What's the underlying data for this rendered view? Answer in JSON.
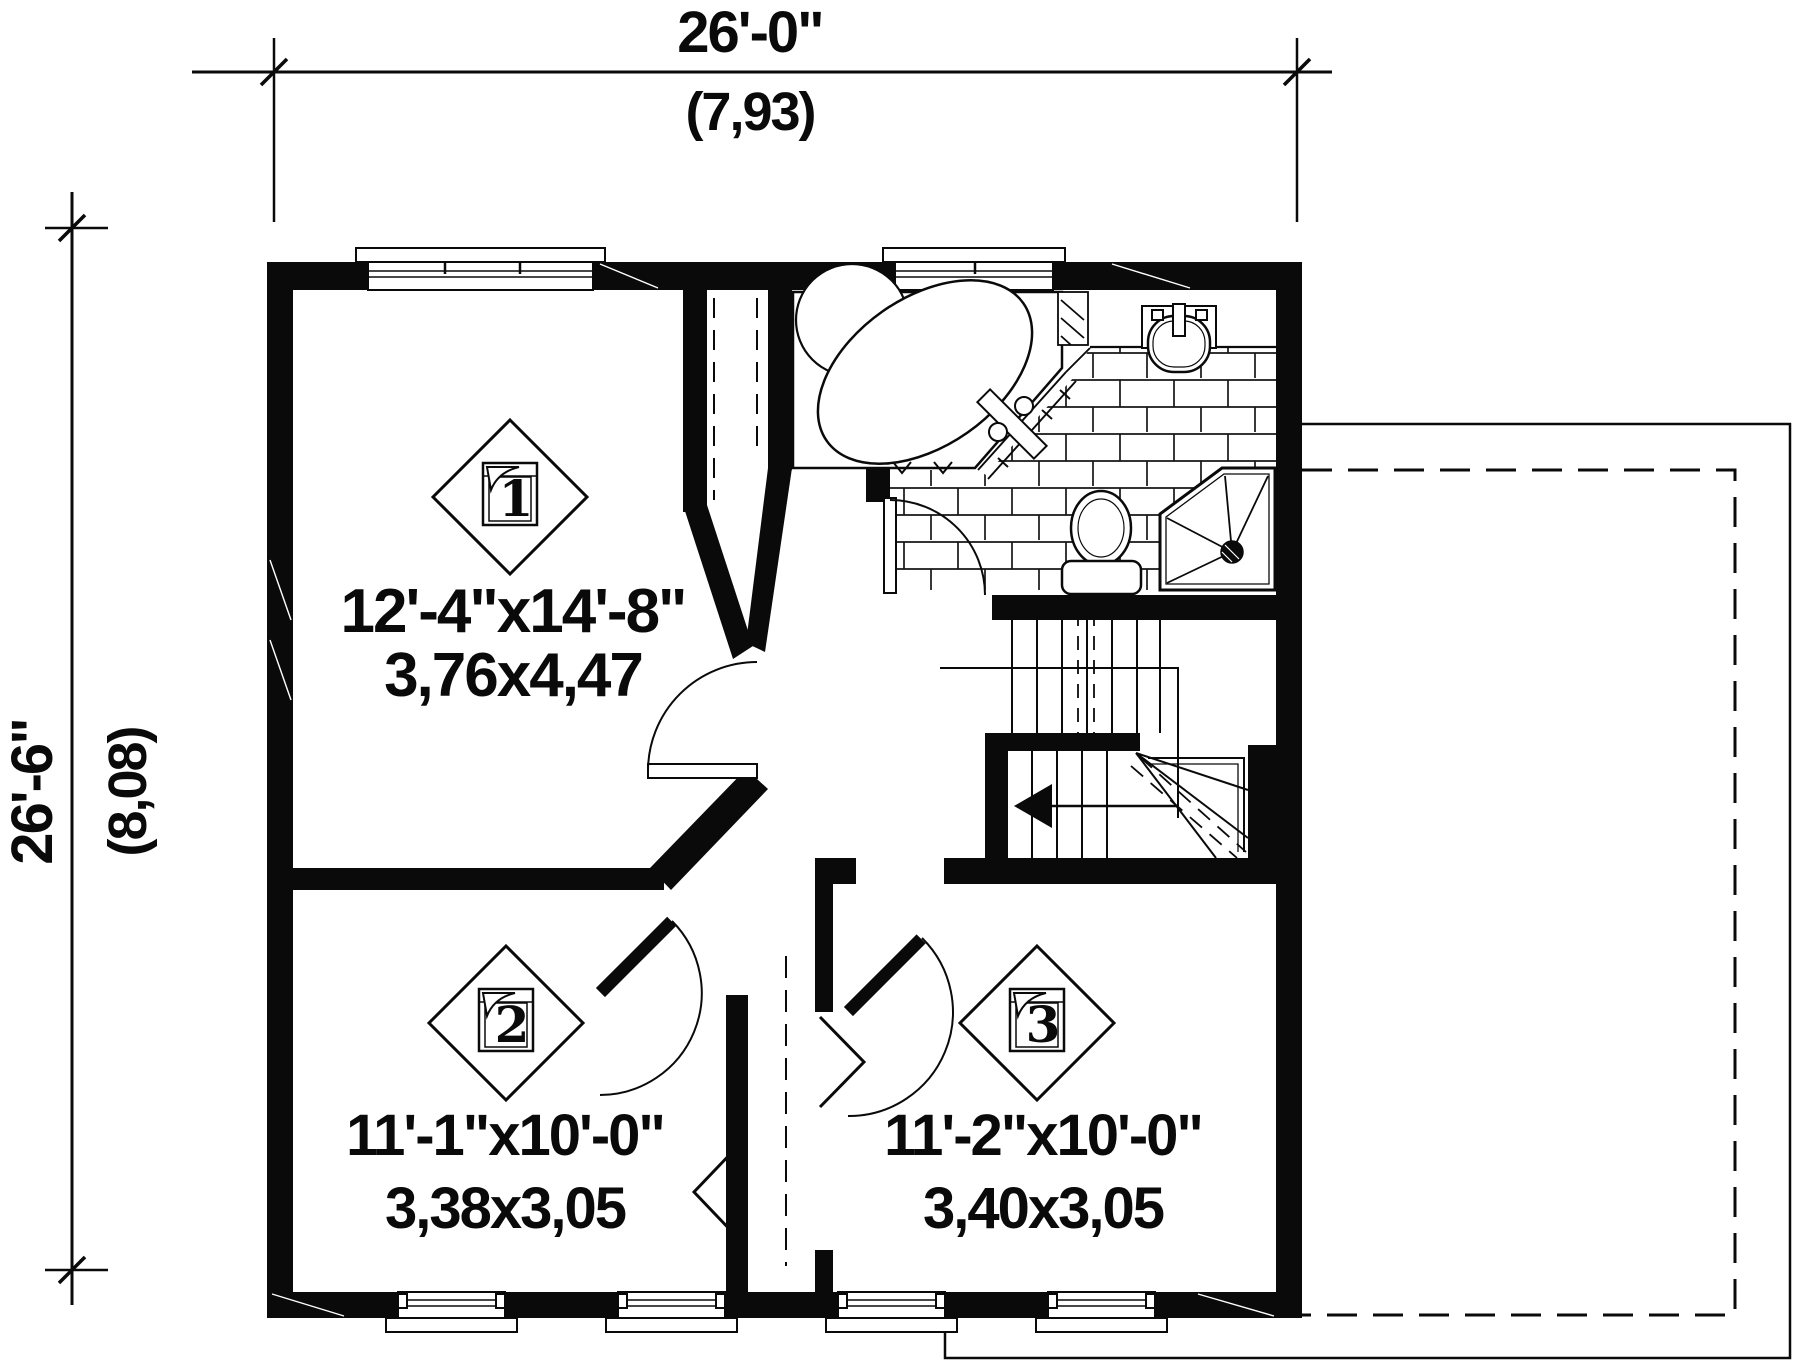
{
  "drawing": {
    "title": "second-floor-plan",
    "dimensions": {
      "top": {
        "imperial": "26'-0\"",
        "metric": "(7,93)"
      },
      "left": {
        "imperial": "26'-6\"",
        "metric": "(8,08)"
      }
    },
    "rooms": [
      {
        "marker": "1",
        "size_imperial": "12'-4\"x14'-8\"",
        "size_metric": "3,76x4,47"
      },
      {
        "marker": "2",
        "size_imperial": "11'-1\"x10'-0\"",
        "size_metric": "3,38x3,05"
      },
      {
        "marker": "3",
        "size_imperial": "11'-2\"x10'-0\"",
        "size_metric": "3,40x3,05"
      }
    ],
    "fixtures": [
      "corner-bathtub",
      "toilet",
      "corner-shower",
      "pedestal-sink",
      "staircase",
      "closets"
    ],
    "colors": {
      "ink": "#0a0a0a",
      "paper": "#ffffff"
    }
  }
}
